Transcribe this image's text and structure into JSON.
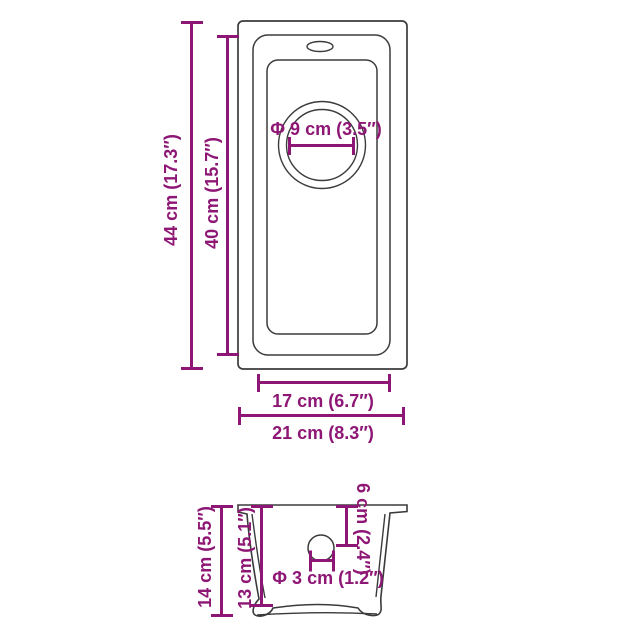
{
  "colors": {
    "dimension_accent": "#8E1775",
    "drawing_outline": "#3B3B3B",
    "background": "#FFFFFF"
  },
  "views": {
    "top": {
      "dimensions": {
        "overall_length": "44 cm (17.3″)",
        "bowl_length": "40 cm (15.7″)",
        "drain_diameter": "Φ 9 cm (3.5″)",
        "bowl_width": "17 cm (6.7″)",
        "overall_width": "21 cm (8.3″)"
      }
    },
    "side": {
      "dimensions": {
        "overall_height": "14 cm (5.5″)",
        "bowl_depth": "13 cm (5.1″)",
        "drain_center_offset": "6 cm (2.4″)",
        "drain_hole_diameter": "Φ 3 cm (1.2″)"
      }
    }
  }
}
